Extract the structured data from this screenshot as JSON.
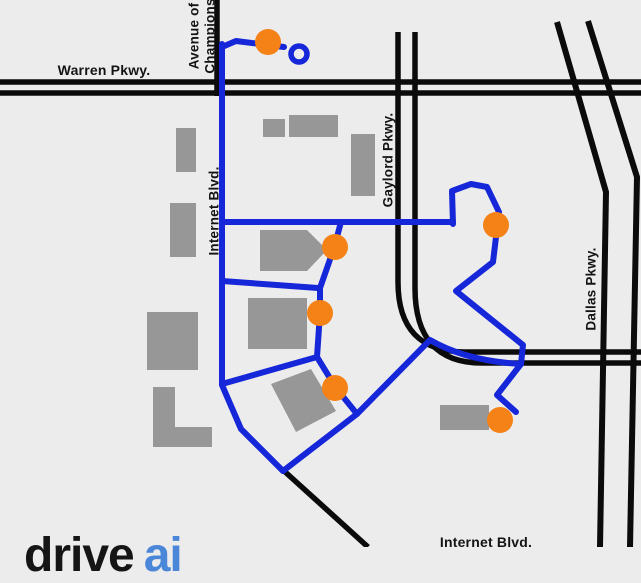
{
  "labels": {
    "warren": "Warren Pkwy.",
    "avenue_line1": "Avenue of",
    "avenue_line2": "Champions",
    "internet_vertical": "Internet Blvd.",
    "gaylord": "Gaylord Pkwy.",
    "dallas": "Dallas Pkwy.",
    "internet_bottom": "Internet Blvd."
  },
  "logo": {
    "black_text": "drive",
    "blue_text": "ai"
  },
  "map": {
    "background_color": "#ececec",
    "road_color": "#0b0b0b",
    "route_color": "#1626d9",
    "stop_color": "#f58216",
    "building_color": "#979797",
    "stop_radius": 13,
    "roads": [
      {
        "name": "warren-pkwy-north",
        "d": "M0,82 H641",
        "w": 5.5
      },
      {
        "name": "warren-pkwy-south",
        "d": "M0,93 H641",
        "w": 5.5
      },
      {
        "name": "avenue-of-champions",
        "d": "M217,0 V96",
        "w": 5.5
      },
      {
        "name": "gaylord-pkwy-west",
        "d": "M398,32 V282 Q398,352 465,352 H641",
        "w": 5.5
      },
      {
        "name": "gaylord-pkwy-east",
        "d": "M415,32 V288 Q415,363 482,363 H641",
        "w": 5.5
      },
      {
        "name": "dallas-pkwy-west",
        "d": "M557,22 L606,192 L600,547",
        "w": 6
      },
      {
        "name": "dallas-pkwy-east",
        "d": "M588,21 L637,177 L630,547",
        "w": 6
      },
      {
        "name": "southeast-diagonal",
        "d": "M283,470 L368,547",
        "w": 5.5
      }
    ],
    "routes": [
      {
        "d": "M222,47 L236,41 L284,47"
      },
      {
        "d": "M222,44 L222,385 L241,429 L283,471"
      },
      {
        "d": "M222,222 L453,222"
      },
      {
        "d": "M453,224 L452,191 L471,184 L487,187 L499,212 L493,262 L456,291 L523,345 L521,364 L497,395 L516,412"
      },
      {
        "d": "M341,222 L334,248 L320,288 L320,313 L317,357 L336,388 L357,414"
      },
      {
        "d": "M222,281 L318,288"
      },
      {
        "d": "M222,384 L317,357"
      },
      {
        "d": "M283,471 L357,414 L430,340 Q466,361 521,364"
      }
    ],
    "loop": {
      "x": 299,
      "y": 54,
      "r": 8
    },
    "stops": [
      {
        "x": 268,
        "y": 42
      },
      {
        "x": 335,
        "y": 247
      },
      {
        "x": 320,
        "y": 313
      },
      {
        "x": 335,
        "y": 388
      },
      {
        "x": 496,
        "y": 225
      },
      {
        "x": 500,
        "y": 420
      }
    ],
    "buildings": [
      {
        "x": 176,
        "y": 128,
        "w": 20,
        "h": 44
      },
      {
        "x": 170,
        "y": 203,
        "w": 26,
        "h": 54
      },
      {
        "x": 263,
        "y": 119,
        "w": 22,
        "h": 18
      },
      {
        "x": 289,
        "y": 115,
        "w": 49,
        "h": 22
      },
      {
        "x": 351,
        "y": 134,
        "w": 24,
        "h": 62
      },
      {
        "points": "260,230 307,230 327,250 307,271 260,271"
      },
      {
        "x": 248,
        "y": 298,
        "w": 59,
        "h": 51
      },
      {
        "points": "271,384 311,369 336,411 296,432"
      },
      {
        "x": 147,
        "y": 312,
        "w": 51,
        "h": 58
      },
      {
        "points": "153,387 175,387 175,427 212,427 212,447 153,447"
      },
      {
        "x": 440,
        "y": 405,
        "w": 49,
        "h": 25
      }
    ]
  }
}
